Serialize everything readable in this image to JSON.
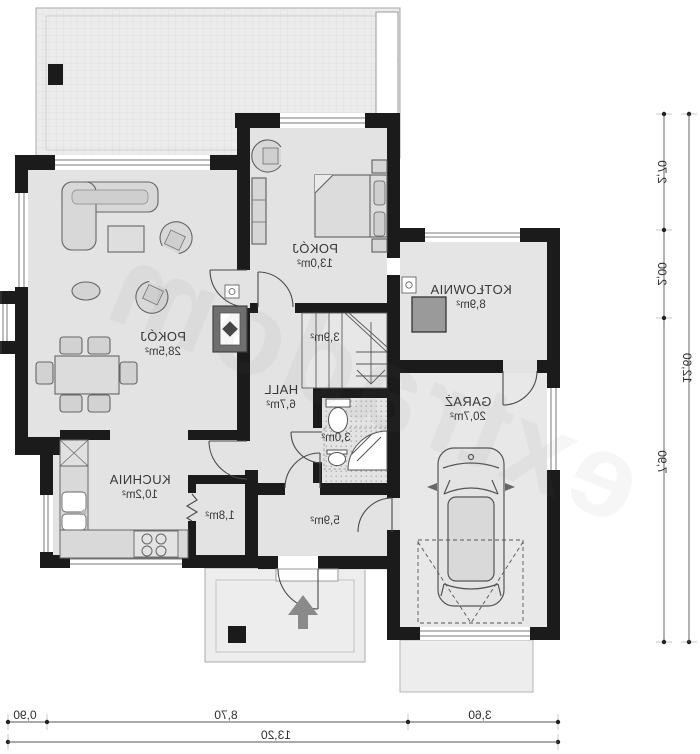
{
  "plan": {
    "title": "house ground floor plan (mirrored print)",
    "watermark": "extradom",
    "colors": {
      "wall": "#1b1b1b",
      "floor": "#e3e3e3",
      "terrace": "#ececec",
      "furniture": "#d8d8d8",
      "boiler": "#9a9a9a",
      "fireplace": "#6f6f6f"
    }
  },
  "rooms": [
    {
      "name": "POKÓJ",
      "area": "28,5m²"
    },
    {
      "name": "POKÓJ",
      "area": "13,0m²"
    },
    {
      "name": "KOTŁOWNIA",
      "area": "8,9m²"
    },
    {
      "name": "GARAŻ",
      "area": "20,7m²"
    },
    {
      "name": "HALL",
      "area": "6,7m²"
    },
    {
      "name": "KUCHNIA",
      "area": "10,2m²"
    },
    {
      "name": "",
      "area": "3,9m²"
    },
    {
      "name": "",
      "area": "3,0m²"
    },
    {
      "name": "",
      "area": "1,8m²"
    },
    {
      "name": "",
      "area": "5,9m²"
    }
  ],
  "dims": {
    "bottom_segments": [
      "0,90",
      "8,70",
      "3,60"
    ],
    "bottom_total": "13,20",
    "right_segments": [
      "2,70",
      "2,00",
      "7,90"
    ],
    "right_total": "12,60"
  }
}
